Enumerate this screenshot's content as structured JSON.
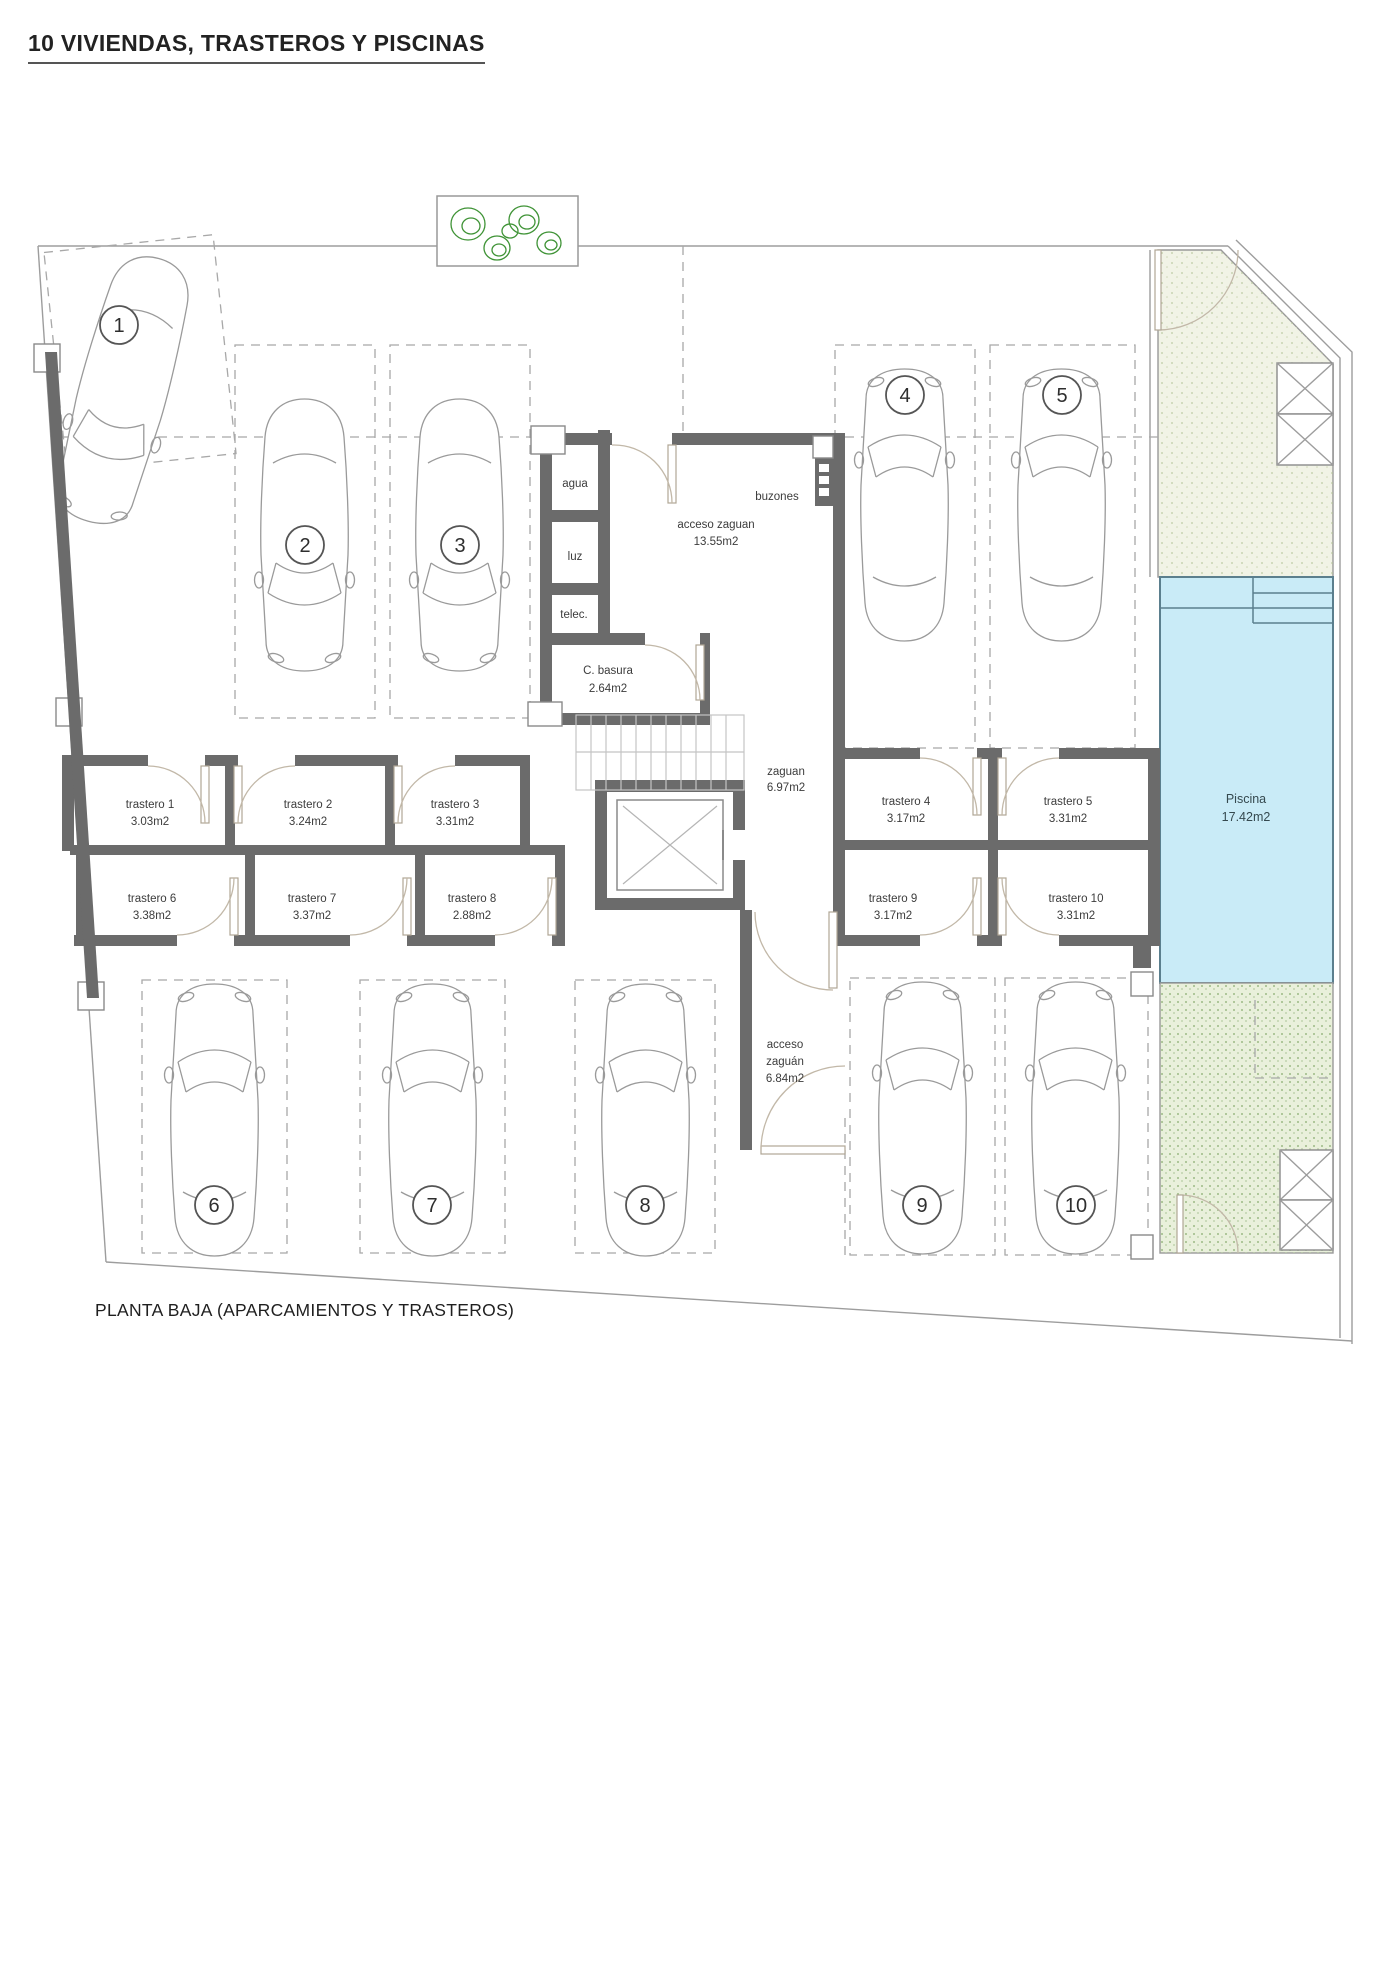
{
  "title": "10 VIVIENDAS, TRASTEROS Y PISCINAS",
  "caption": "PLANTA BAJA (APARCAMIENTOS Y TRASTEROS)",
  "plan": {
    "parking": [
      "1",
      "2",
      "3",
      "4",
      "5",
      "6",
      "7",
      "8",
      "9",
      "10"
    ],
    "trasteros": [
      {
        "name": "trastero 1",
        "area": "3.03m2"
      },
      {
        "name": "trastero 2",
        "area": "3.24m2"
      },
      {
        "name": "trastero 3",
        "area": "3.31m2"
      },
      {
        "name": "trastero 4",
        "area": "3.17m2"
      },
      {
        "name": "trastero 5",
        "area": "3.31m2"
      },
      {
        "name": "trastero 6",
        "area": "3.38m2"
      },
      {
        "name": "trastero 7",
        "area": "3.37m2"
      },
      {
        "name": "trastero 8",
        "area": "2.88m2"
      },
      {
        "name": "trastero 9",
        "area": "3.17m2"
      },
      {
        "name": "trastero 10",
        "area": "3.31m2"
      }
    ],
    "utilities": {
      "agua": "agua",
      "luz": "luz",
      "telec": "telec.",
      "buzones": "buzones"
    },
    "basura": {
      "name": "C. basura",
      "area": "2.64m2"
    },
    "acceso_zaguan": {
      "name": "acceso zaguan",
      "area": "13.55m2"
    },
    "zaguan": {
      "name": "zaguan",
      "area": "6.97m2"
    },
    "acceso_zaguan_sur": {
      "l1": "acceso",
      "l2": "zaguán",
      "l3": "6.84m2"
    },
    "piscina": {
      "name": "Piscina",
      "area": "17.42m2"
    },
    "colors": {
      "wall": "#6b6b6b",
      "pool_fill": "#c9ebf7",
      "pool_border": "#5b7f8e",
      "garden_top": "#f1f3e6",
      "garden_bottom": "#e9f0db",
      "tree_green": "#3f9336"
    }
  }
}
